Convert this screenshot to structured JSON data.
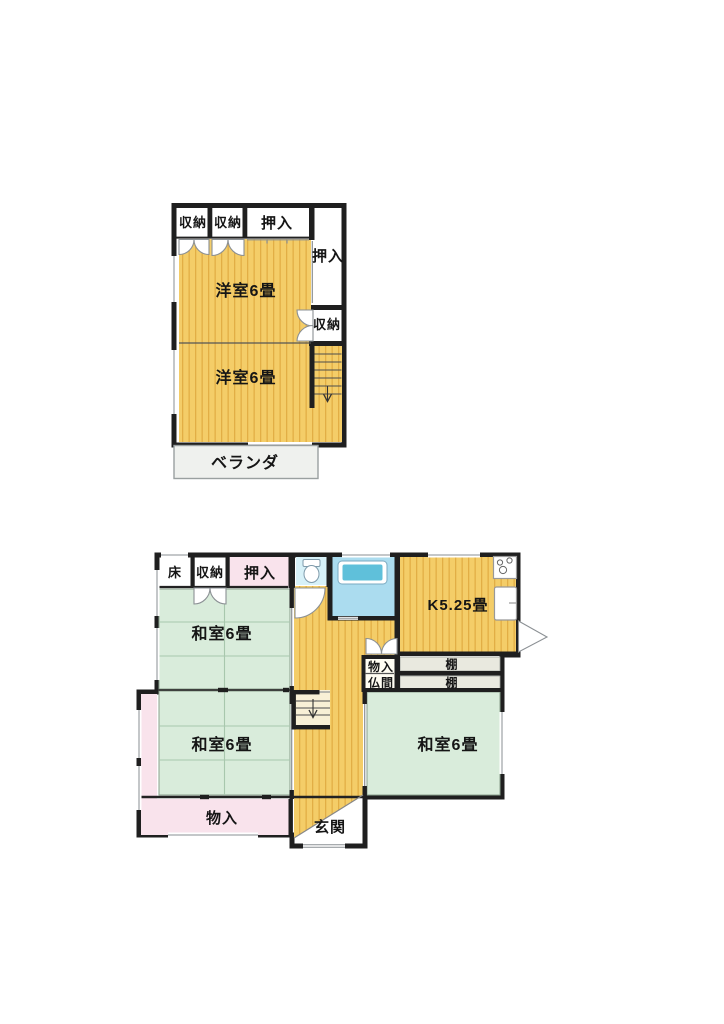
{
  "document_type": "floor-plan",
  "colors": {
    "wall": "#1f1f1f",
    "flooring_yellow": "#f4cd68",
    "flooring_stripe": "#e2ae45",
    "tatami_green": "#d9ecdb",
    "closet_pink": "#f9e3ec",
    "toilet_cyan": "#d7f1f8",
    "bath_blue": "#abdcef",
    "bathtub_blue": "#5fc0da",
    "veranda_gray": "#eff1ee",
    "shelf_gray": "#e9e9df",
    "stairs_cream": "#f8f0d6",
    "white": "#ffffff"
  },
  "floor2": {
    "rooms": {
      "closet_a": "収納",
      "closet_b": "収納",
      "oshiire_top": "押入",
      "oshiire_right": "押入",
      "closet_right": "収納",
      "western_room_upper": "洋室6畳",
      "western_room_lower": "洋室6畳",
      "veranda": "ベランダ"
    }
  },
  "floor1": {
    "rooms": {
      "tokonoma": "床",
      "closet": "収納",
      "oshiire": "押入",
      "kitchen": "K5.25畳",
      "storage_small": "物入",
      "butsuma": "仏間",
      "shelf_top": "棚",
      "shelf_bottom": "棚",
      "washitsu_nw": "和室6畳",
      "washitsu_sw": "和室6畳",
      "washitsu_e": "和室6畳",
      "storage_bottom": "物入",
      "entrance": "玄関"
    }
  }
}
